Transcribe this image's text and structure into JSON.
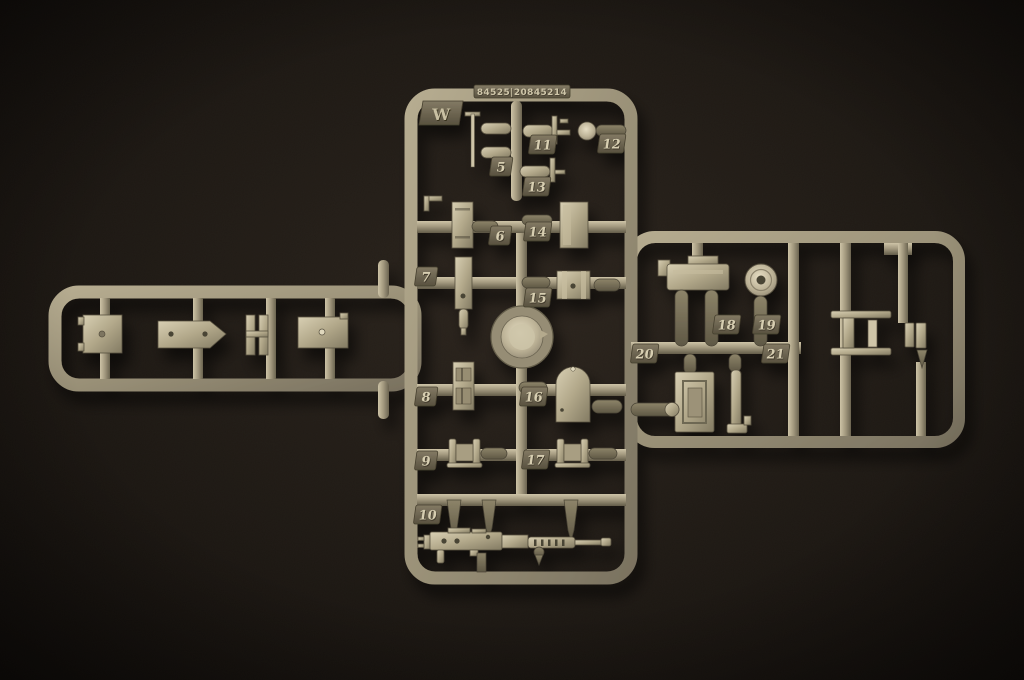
{
  "photo": {
    "subject_label": "model-kit-sprue-photo"
  },
  "sprue": {
    "code": "84525|20845214",
    "gate_letter": "W",
    "part_numbers": [
      "5",
      "6",
      "7",
      "8",
      "9",
      "10",
      "11",
      "12",
      "13",
      "14",
      "15",
      "16",
      "17",
      "18",
      "19",
      "20",
      "21"
    ]
  },
  "colors": {
    "background": "#1c1713",
    "plastic_light": "#d6ccae",
    "plastic_mid": "#9a9178",
    "plastic_dark": "#6e6753",
    "tab_fill": "#6b6450",
    "emboss_text": "#d7ceb1"
  }
}
